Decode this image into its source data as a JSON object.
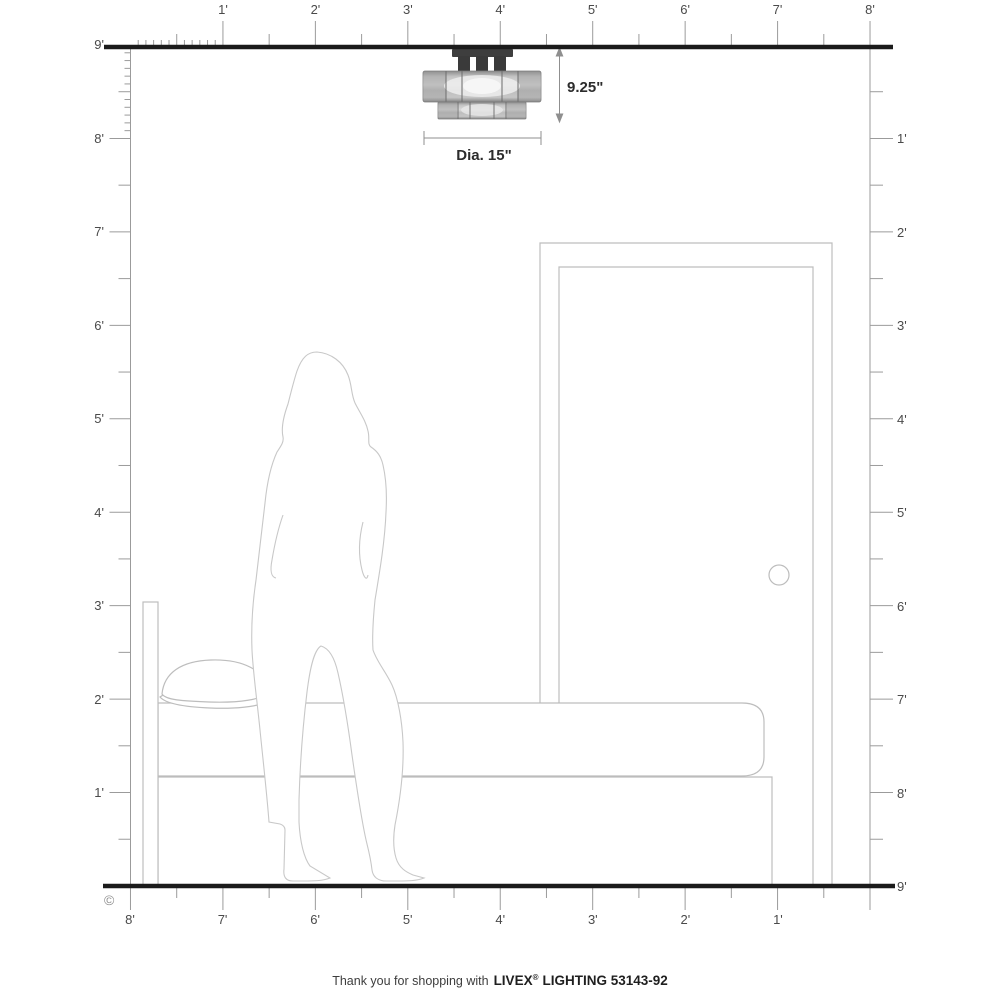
{
  "title": "Livex Lighting flush mount scale diagram",
  "fixture": {
    "height_label": "9.25\"",
    "diameter_label": "Dia. 15\""
  },
  "rulers": {
    "top": [
      "1'",
      "2'",
      "3'",
      "4'",
      "5'",
      "6'",
      "7'",
      "8'"
    ],
    "bottom": [
      "8'",
      "7'",
      "6'",
      "5'",
      "4'",
      "3'",
      "2'",
      "1'"
    ],
    "left": [
      "9'",
      "8'",
      "7'",
      "6'",
      "5'",
      "4'",
      "3'",
      "2'",
      "1'"
    ],
    "right": [
      "1'",
      "2'",
      "3'",
      "4'",
      "5'",
      "6'",
      "7'",
      "8'",
      "9'"
    ]
  },
  "footer": {
    "prefix": "Thank you for shopping with",
    "brand": "LIVEX",
    "registered": "®",
    "suffix": "LIGHTING 53143-92"
  },
  "copyright": "©",
  "scene_items": [
    "ceiling-line",
    "floor-line",
    "left-wall-ruler",
    "right-wall-ruler",
    "flush-mount-light",
    "door",
    "bed-with-pillow",
    "standing-woman-outline"
  ],
  "colors": {
    "background": "#ffffff",
    "heavy_line": "#1b1b1b",
    "ruler_line": "#9b9b9b",
    "ruler_label": "#4a4a4a",
    "furniture_line": "#bdbdbd",
    "figure_line": "#c8c8c8",
    "dimension_line": "#8f8f8f",
    "dimension_text": "#2c2c2c",
    "fixture_canopy": "#3e3e3e",
    "fixture_glass": "#c0c0c0",
    "fixture_glass_highlight": "#ededed",
    "fixture_glass_edge": "#6f6f6f"
  }
}
